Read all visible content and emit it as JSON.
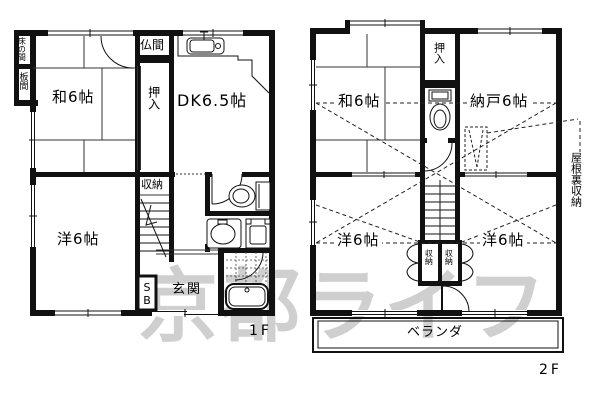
{
  "watermark": "京都ライフ",
  "floor1": {
    "floor_label": "1F",
    "washitsu": "和6帖",
    "dk": "DK6.5帖",
    "youshitsu": "洋6帖",
    "tokonoma": "床の間",
    "itanoma": "板間",
    "butsuma": "仏間",
    "oshiire": "押入",
    "shuunou": "収納",
    "genkan": "玄関",
    "shoebox": "SB"
  },
  "floor2": {
    "floor_label": "2F",
    "washitsu": "和6帖",
    "nando": "納戸6帖",
    "oshiire": "押入",
    "youshitsu_left": "洋6帖",
    "youshitsu_right": "洋6帖",
    "closet_left": "収納",
    "closet_right": "収納",
    "veranda": "ベランダ",
    "attic": "屋根裏収納"
  }
}
